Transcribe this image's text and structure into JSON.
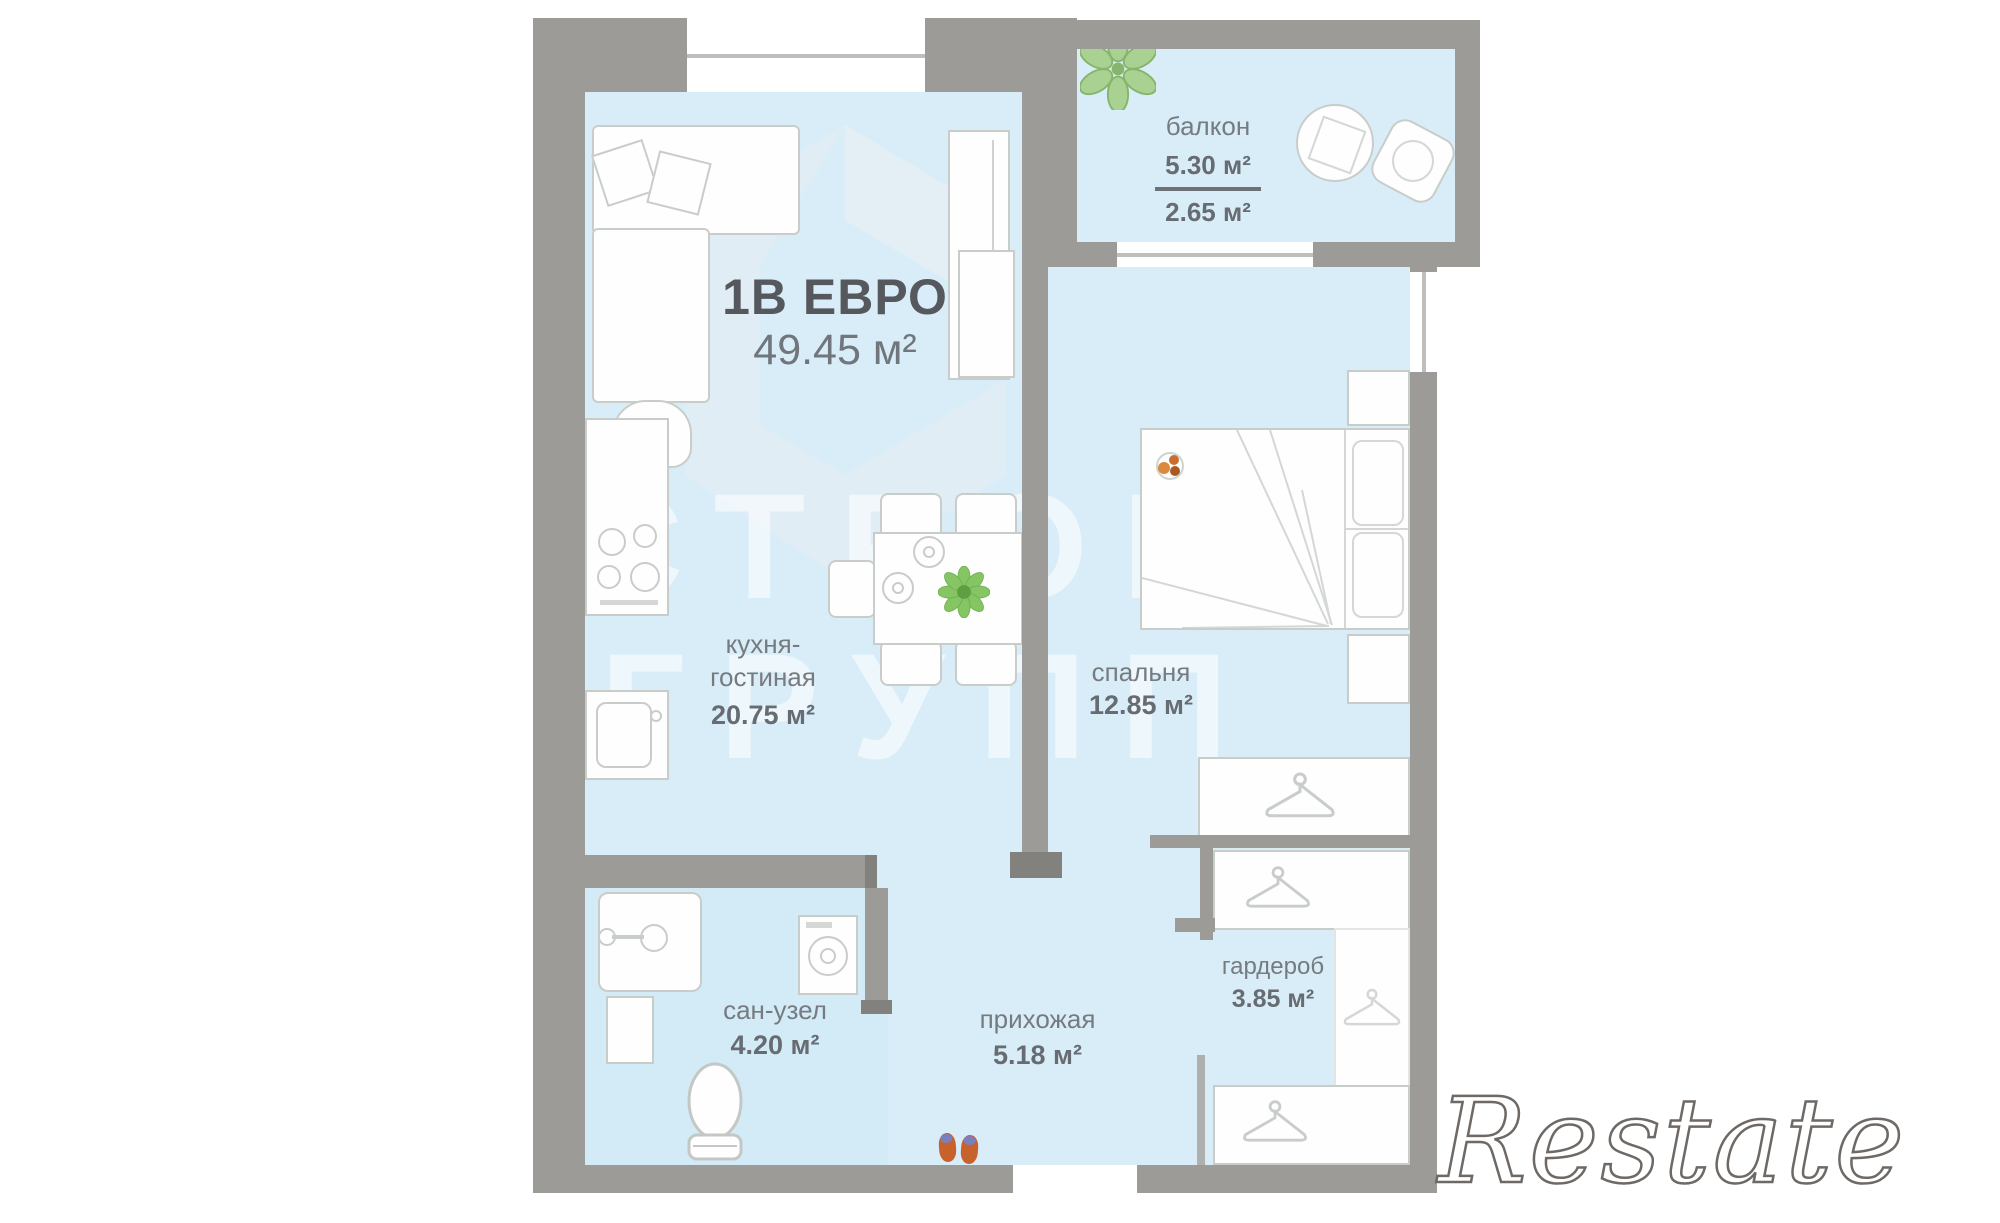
{
  "plan": {
    "title": "1В ЕВРО",
    "total_area": "49.45 м²",
    "rooms": {
      "balcony": {
        "name": "балкон",
        "area_full": "5.30 м²",
        "area_reduced": "2.65 м²"
      },
      "kitchen_living": {
        "name_line1": "кухня-",
        "name_line2": "гостиная",
        "area": "20.75 м²"
      },
      "bedroom": {
        "name": "спальня",
        "area": "12.85 м²"
      },
      "bathroom": {
        "name": "сан-узел",
        "area": "4.20 м²"
      },
      "hallway": {
        "name": "прихожая",
        "area": "5.18 м²"
      },
      "wardrobe": {
        "name": "гардероб",
        "area": "3.85 м²"
      }
    }
  },
  "watermarks": {
    "agency": "Restate",
    "developer_line1": "СТРОИМ",
    "developer_line2": "ГРУПП"
  },
  "colors": {
    "wall": "#9c9b98",
    "floor": "#d9edf8",
    "plant_green": "#8cc46b",
    "slipper_orange": "#c7622d",
    "label_gray": "#70767b"
  }
}
